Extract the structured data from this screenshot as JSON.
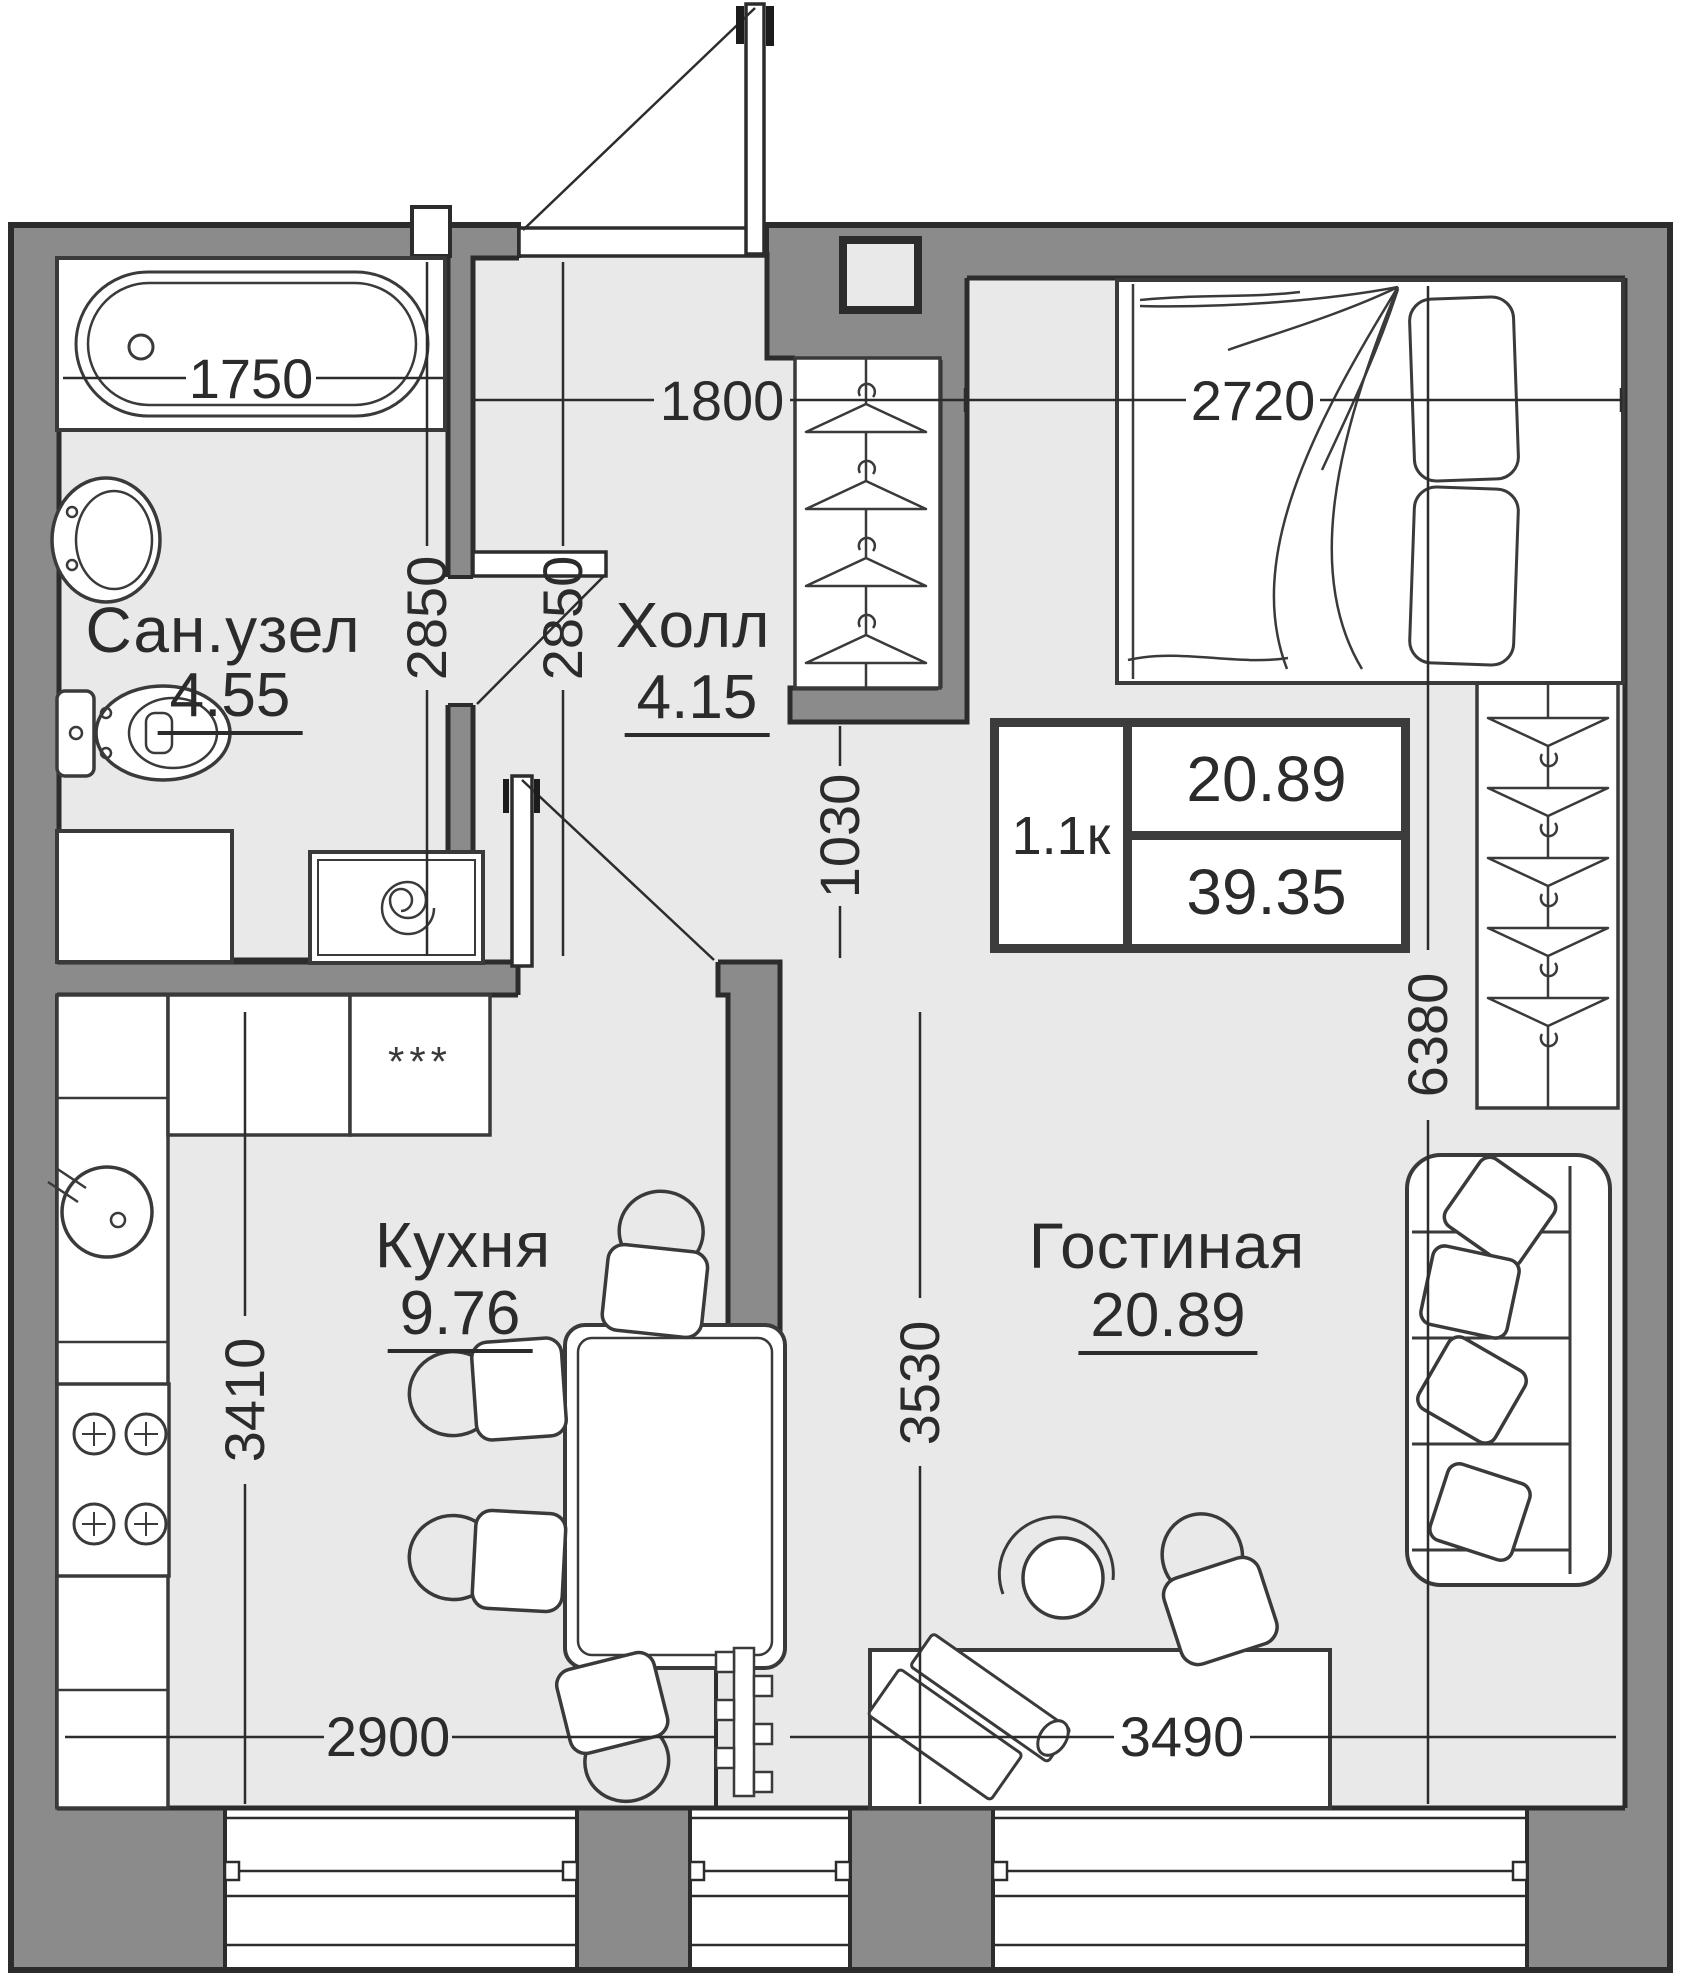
{
  "rooms": [
    {
      "name": "Сан.узел",
      "area": "4.55"
    },
    {
      "name": "Холл",
      "area": "4.15"
    },
    {
      "name": "Кухня",
      "area": "9.76"
    },
    {
      "name": "Гостиная",
      "area": "20.89"
    }
  ],
  "info_box": {
    "plan_type": "1.1к",
    "living_area": "20.89",
    "total_area": "39.35"
  },
  "dimensions": {
    "bathtub": "1750",
    "hall_width": "1800",
    "bed_zone_width": "2720",
    "bathroom_depth": "2850",
    "hall_depth": "2850",
    "wardrobe_passage": "1030",
    "living_length": "6380",
    "kitchen_depth": "3410",
    "living_depth": "3530",
    "kitchen_width": "2900",
    "living_width": "3490"
  },
  "markers": {
    "appliance": "***"
  },
  "colors": {
    "wall_fill": "#8b8b8b",
    "wall_outline": "#2c2c2c",
    "floor": "#e9e9e9",
    "furniture_stroke": "#3a3a3a",
    "text": "#2b2b2b"
  }
}
